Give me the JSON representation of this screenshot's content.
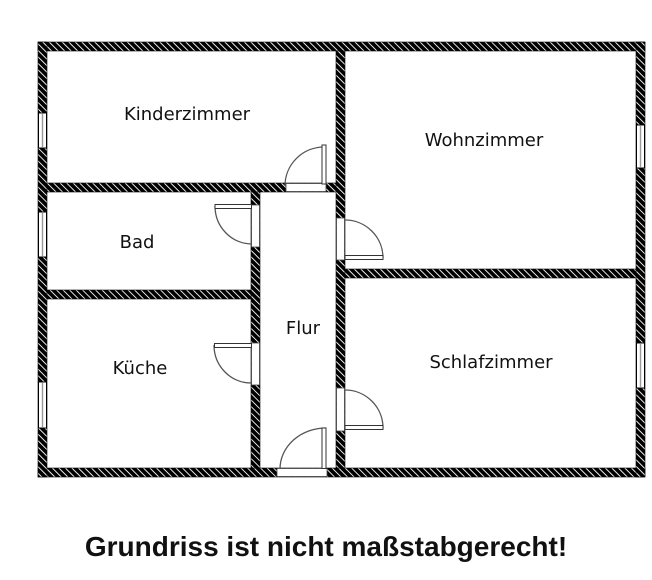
{
  "caption": "Grundriss ist nicht maßstabgerecht!",
  "rooms": [
    {
      "name": "kinderzimmer",
      "label": "Kinderzimmer"
    },
    {
      "name": "wohnzimmer",
      "label": "Wohnzimmer"
    },
    {
      "name": "bad",
      "label": "Bad"
    },
    {
      "name": "kueche",
      "label": "Küche"
    },
    {
      "name": "flur",
      "label": "Flur"
    },
    {
      "name": "schlafzimmer",
      "label": "Schlafzimmer"
    }
  ],
  "openings": {
    "doors": 6,
    "windows": 5
  },
  "colors": {
    "background": "#ffffff",
    "wall_fill": "#000000",
    "wall_hatch_line": "#ffffff",
    "label_text": "#111111",
    "caption_text": "#111111",
    "door_symbol": "#555555"
  }
}
